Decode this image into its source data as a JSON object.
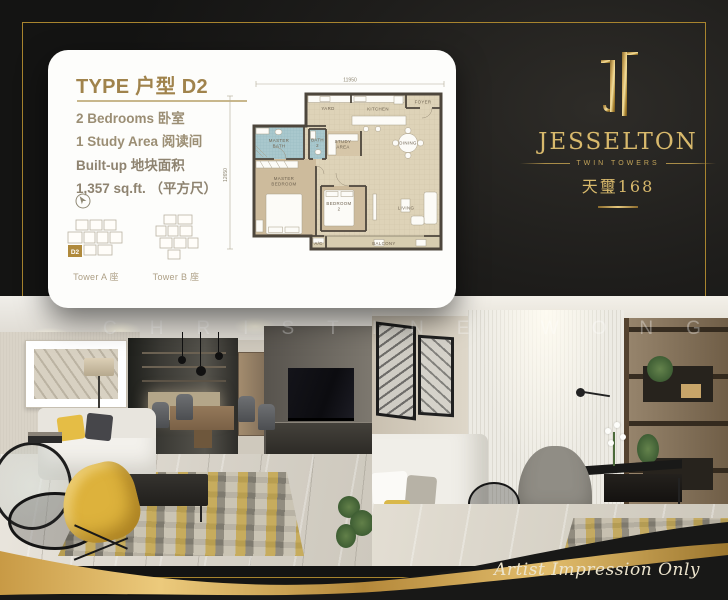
{
  "card": {
    "title": "TYPE 户型 D2",
    "features": [
      {
        "label": "2 Bedrooms 卧室"
      },
      {
        "label": "1 Study Area 阅读间"
      }
    ],
    "builtup": {
      "label": "Built-up 地块面积",
      "value": "1,357 sq.ft. （平方尺）"
    },
    "keyplans": [
      {
        "label": "Tower A 座",
        "unit": "D2"
      },
      {
        "label": "Tower B 座"
      }
    ]
  },
  "floor_plan": {
    "dimensions": {
      "top": "11950",
      "left": "12650"
    },
    "rooms": {
      "foyer": "FOYER",
      "yard": "YARD",
      "kitchen": "KITCHEN",
      "master_bath_1": "MASTER",
      "master_bath_2": "BATH",
      "bath2_1": "BATH",
      "bath2_2": "2",
      "study_1": "STUDY",
      "study_2": "AREA",
      "dining": "DINING",
      "master_bedroom_1": "MASTER",
      "master_bedroom_2": "BEDROOM",
      "bedroom2_1": "BEDROOM",
      "bedroom2_2": "2",
      "living": "LIVING",
      "balcony": "BALCONY",
      "ac": "A/C"
    }
  },
  "logo": {
    "monogram_icon": "jt-monogram",
    "name": "JESSELTON",
    "subtitle": "TWIN TOWERS",
    "chinese": "天璽168"
  },
  "photos": {
    "watermark": "CHRISTINE WONG"
  },
  "footer": {
    "note": "Artist Impression Only"
  },
  "colors": {
    "gold": "#c9a55a",
    "title_gold": "#a0834c",
    "background": "#1a1918",
    "bath_blue": "#a9c8cd",
    "floor_beige": "#ded3b8",
    "bedroom_tan": "#cdbb9c"
  }
}
